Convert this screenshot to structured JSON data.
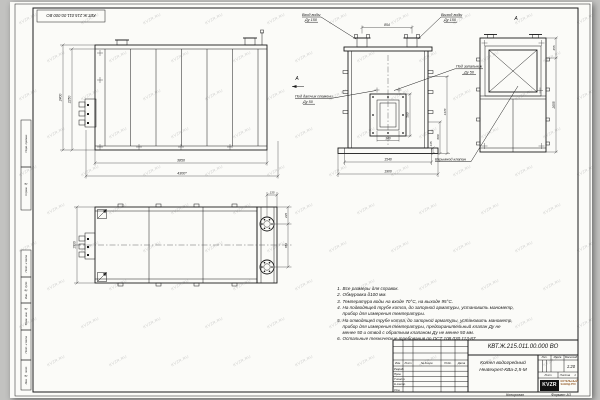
{
  "sheet": {
    "watermark": "KVZR.RU",
    "copied": "Копировал",
    "format": "Формат А3",
    "paper_color": "#fbfbf8",
    "line_color": "#1b1b1b",
    "frame_labels": [
      {
        "label": "Перв. примен."
      },
      {
        "label": "Справ. №"
      },
      {
        "label": "Подп. и дата"
      },
      {
        "label": "Инв. № дубл."
      },
      {
        "label": "Взам. инв. №"
      },
      {
        "label": "Подп. и дата"
      },
      {
        "label": "Инв. № подл."
      }
    ]
  },
  "front_view": {
    "dim_height_outer": "2400",
    "dim_height_inner": "2250",
    "dim_width_inner": "3850",
    "dim_width_outer": "4300*"
  },
  "section_view": {
    "view_arrow": "А",
    "label_inlet_1": "Вход воды",
    "label_inlet_2": "Ду 150",
    "label_outlet_1": "Выход воды",
    "label_outlet_2": "Ду 150",
    "label_igniter_1": "Под запальник",
    "label_igniter_2": "Ду 50",
    "label_flame_1": "Под датчик пламени",
    "label_flame_2": "Ду 50",
    "dim_nozzles": "854",
    "dim_burner_h": "580",
    "dim_burner_w": "340",
    "dim_base_h": "135",
    "dim_h600": "600",
    "dim_h1470": "1470",
    "dim_base_inner": "1540",
    "dim_base_outer": "1900"
  },
  "view_a": {
    "title": "А",
    "label_valve": "Взрывной клапан",
    "dim_top": "455",
    "dim_main": "2055"
  },
  "plan_view": {
    "dim_width": "1900",
    "dim_offset": "135",
    "dim_edge": "235",
    "dim_nozzles": "854"
  },
  "notes": [
    {
      "num": "1.",
      "text": "Все размеры для справок."
    },
    {
      "num": "2.",
      "text": "Обмуровка δ100 мм."
    },
    {
      "num": "3.",
      "text": "Температура воды на входе 70°С, на выходе 95°С."
    },
    {
      "num": "4.",
      "text": "На подводящей трубе котла, до запорной арматуры, установить манометр, прибор для измерения температуры."
    },
    {
      "num": "5.",
      "text": "На отводящей трубе котла, до запорной арматуры, установить манометр, прибор для измерения температуры, предохранительный клапан Ду не менее 50 и отвод с обратным клапаном Ду не менее 50 мм."
    },
    {
      "num": "6.",
      "text": "Остальные технические требования по ОСТ 108.030.113-87."
    }
  ],
  "title_block": {
    "doc_number": "КВТ.Ж.215.011.00.000 ВО",
    "product_1": "Котел водогрейный",
    "product_2": "Heatexpert-КВа-2,5-М",
    "col_izm": "Изм.",
    "col_list": "Лист",
    "col_doc": "№ докум.",
    "col_sign": "Подп.",
    "col_date": "Дата",
    "row_razrab": "Разраб.",
    "row_prov": "Пров.",
    "row_tkontr": "Т.контр.",
    "row_nkontr": "Н.контр.",
    "row_utv": "Утв.",
    "lit": "Лит.",
    "mass": "Масса",
    "scale_label": "Масштаб",
    "scale": "1:20",
    "sheet_label": "Лист",
    "sheets_label": "Листов",
    "sheets_value": "1",
    "logo": "KVZR",
    "company_1": "КОТЕЛЬНЫЙ",
    "company_2": "ЗАВОД.РУС"
  }
}
